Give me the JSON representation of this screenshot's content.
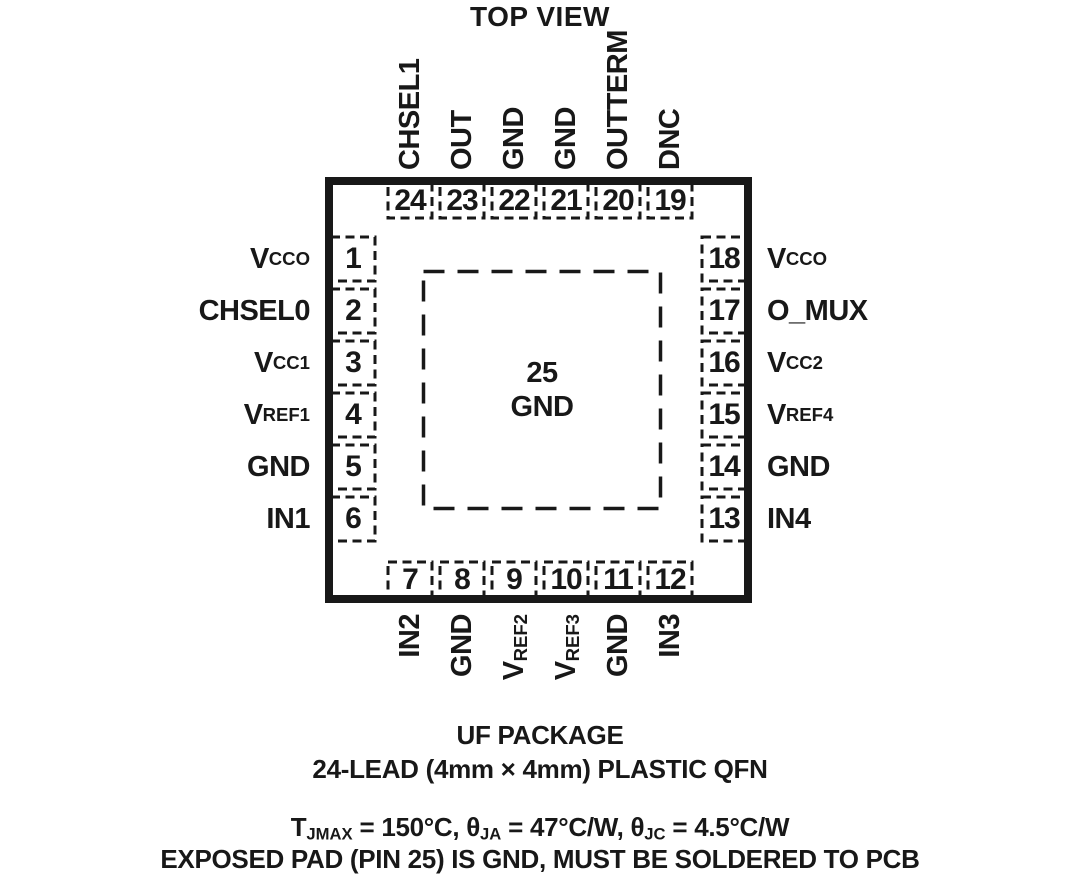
{
  "title": "TOP VIEW",
  "chip": {
    "exposed_pad": {
      "number": "25",
      "name": "GND"
    },
    "pins": {
      "top": [
        {
          "number": "24",
          "label": [
            {
              "t": "CHSEL1"
            }
          ]
        },
        {
          "number": "23",
          "label": [
            {
              "t": "OUT"
            }
          ]
        },
        {
          "number": "22",
          "label": [
            {
              "t": "GND"
            }
          ]
        },
        {
          "number": "21",
          "label": [
            {
              "t": "GND"
            }
          ]
        },
        {
          "number": "20",
          "label": [
            {
              "t": "OUTTERM"
            }
          ]
        },
        {
          "number": "19",
          "label": [
            {
              "t": "DNC"
            }
          ]
        }
      ],
      "left": [
        {
          "number": "1",
          "label": [
            {
              "t": "V"
            },
            {
              "t": "CCO",
              "sub": true
            }
          ]
        },
        {
          "number": "2",
          "label": [
            {
              "t": "CHSEL0"
            }
          ]
        },
        {
          "number": "3",
          "label": [
            {
              "t": "V"
            },
            {
              "t": "CC1",
              "sub": true
            }
          ]
        },
        {
          "number": "4",
          "label": [
            {
              "t": "V"
            },
            {
              "t": "REF1",
              "sub": true
            }
          ]
        },
        {
          "number": "5",
          "label": [
            {
              "t": "GND"
            }
          ]
        },
        {
          "number": "6",
          "label": [
            {
              "t": "IN1"
            }
          ]
        }
      ],
      "right": [
        {
          "number": "18",
          "label": [
            {
              "t": "V"
            },
            {
              "t": "CCO",
              "sub": true
            }
          ]
        },
        {
          "number": "17",
          "label": [
            {
              "t": "O_MUX"
            }
          ]
        },
        {
          "number": "16",
          "label": [
            {
              "t": "V"
            },
            {
              "t": "CC2",
              "sub": true
            }
          ]
        },
        {
          "number": "15",
          "label": [
            {
              "t": "V"
            },
            {
              "t": "REF4",
              "sub": true
            }
          ]
        },
        {
          "number": "14",
          "label": [
            {
              "t": "GND"
            }
          ]
        },
        {
          "number": "13",
          "label": [
            {
              "t": "IN4"
            }
          ]
        }
      ],
      "bottom": [
        {
          "number": "7",
          "label": [
            {
              "t": "IN2"
            }
          ]
        },
        {
          "number": "8",
          "label": [
            {
              "t": "GND"
            }
          ]
        },
        {
          "number": "9",
          "label": [
            {
              "t": "V"
            },
            {
              "t": "REF2",
              "sub": true
            }
          ]
        },
        {
          "number": "10",
          "label": [
            {
              "t": "V"
            },
            {
              "t": "REF3",
              "sub": true
            }
          ]
        },
        {
          "number": "11",
          "label": [
            {
              "t": "GND"
            }
          ]
        },
        {
          "number": "12",
          "label": [
            {
              "t": "IN3"
            }
          ]
        }
      ]
    }
  },
  "footer": {
    "package_title": "UF PACKAGE",
    "package_subtitle": "24-LEAD (4mm × 4mm) PLASTIC QFN",
    "thermal": [
      {
        "t": "T"
      },
      {
        "t": "JMAX",
        "sub": true
      },
      {
        "t": " = 150°C, θ"
      },
      {
        "t": "JA",
        "sub": true
      },
      {
        "t": " = 47°C/W, θ"
      },
      {
        "t": "JC",
        "sub": true
      },
      {
        "t": " = 4.5°C/W"
      }
    ],
    "note": "EXPOSED PAD (PIN 25) IS GND, MUST BE SOLDERED TO PCB"
  }
}
